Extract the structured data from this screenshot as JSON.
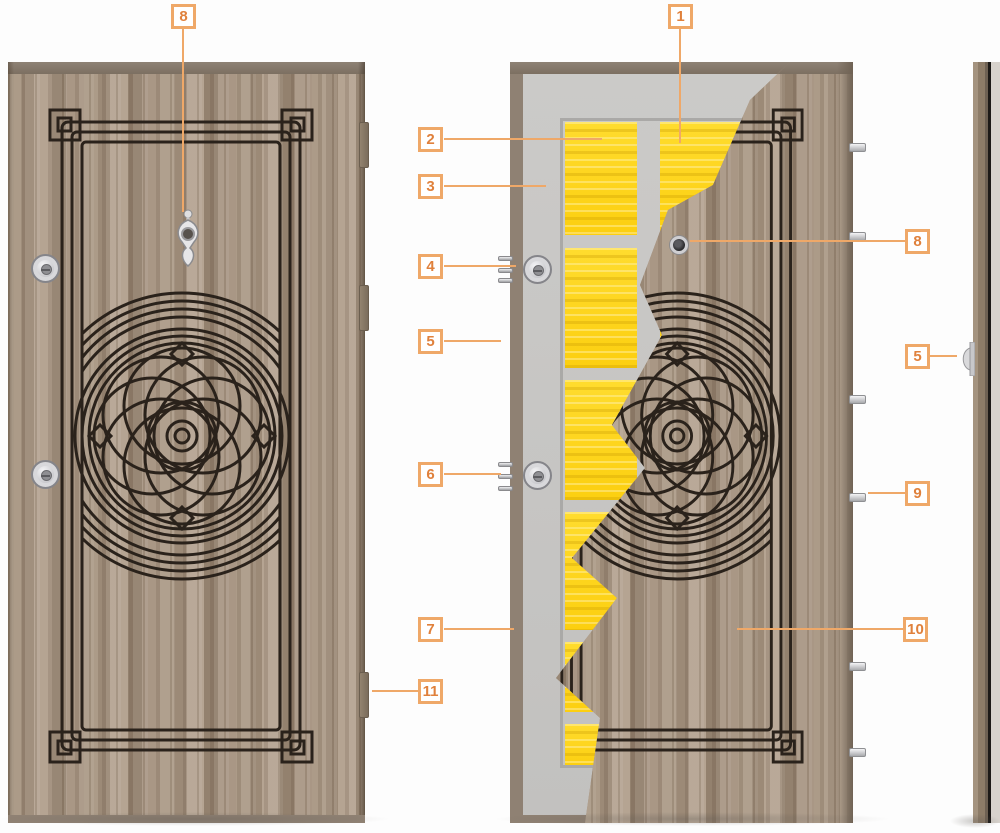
{
  "diagram": {
    "callouts": {
      "knocker": "8",
      "steel_sheet": "1",
      "insulation": "2",
      "steel_body": "3",
      "lock_top": "4",
      "frame_edge": "5",
      "lock_bottom": "6",
      "inner_sheet": "7",
      "hinge": "11",
      "peephole": "8",
      "security_pin": "9",
      "wood_panel": "10",
      "side_peephole": "5"
    },
    "colors": {
      "accent": "#EFA868",
      "accent_text": "#E0813C",
      "insulation_yellow": "#FFD91E",
      "steel_gray": "#C7C6C4",
      "wood_brown": "#A5937F",
      "pattern_line": "#2A221B",
      "frame_brown": "#8F8173"
    }
  }
}
